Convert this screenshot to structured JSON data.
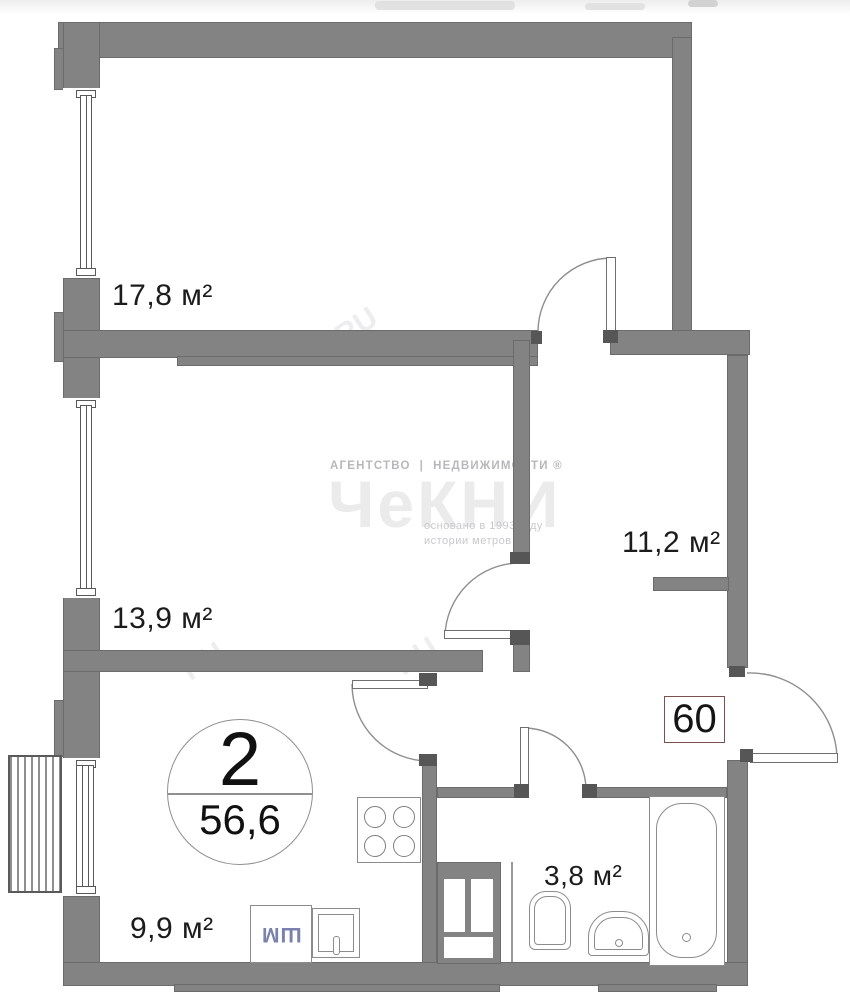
{
  "plan": {
    "badge": {
      "rooms": "2",
      "area": "56,6"
    },
    "apartment_number": "60",
    "rooms": {
      "room1": {
        "label": "17,8 м²"
      },
      "room2": {
        "label": "13,9 м²"
      },
      "hall": {
        "label": "11,2 м²"
      },
      "kitchen": {
        "label": "9,9 м²"
      },
      "bathroom": {
        "label": "3,8 м²"
      }
    },
    "appliances": {
      "washing_machine": "ШМ"
    },
    "watermark": {
      "agency": "АГЕНТСТВО",
      "separator": "|",
      "realty": "НЕДВИЖИМОСТИ ®",
      "brand": "ЧеКНИ",
      "founded": "основано в 1993 году",
      "tagline": "истории метров",
      "ru_mark": "RU"
    },
    "colors": {
      "wall": "#838383",
      "label_text": "#1c1c1c",
      "apartment_badge_border": "#7d5050",
      "washer_text": "#7b81ad"
    }
  }
}
